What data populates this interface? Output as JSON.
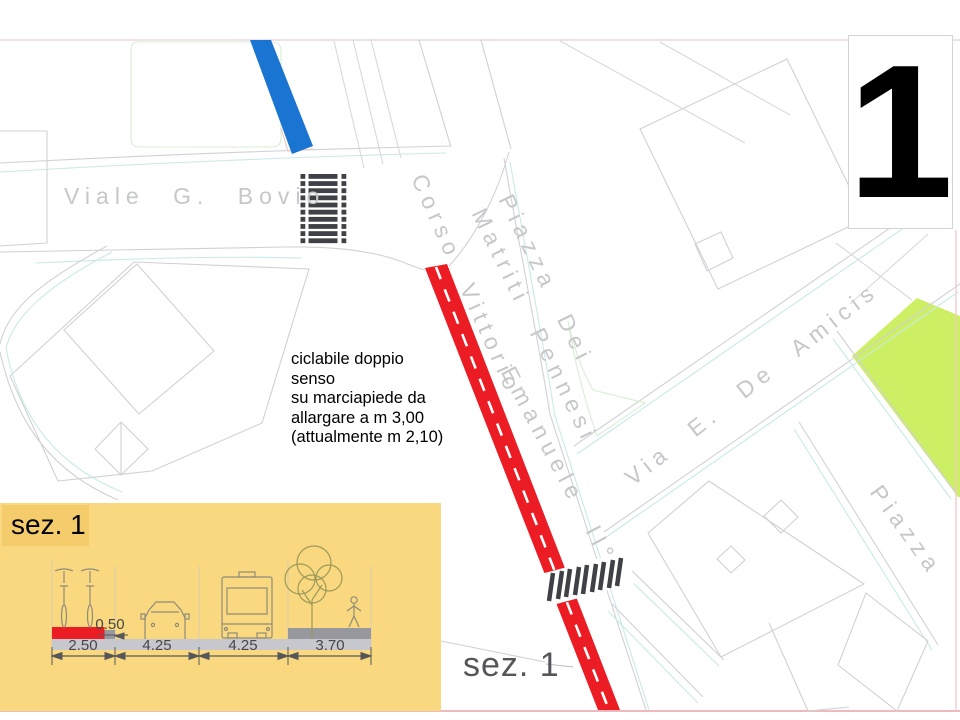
{
  "sheet": {
    "number": "1"
  },
  "map": {
    "streets": {
      "viale_bovio": "Viale G. Bovio",
      "corso_vittorio": "Corso Vittorio",
      "emanuele_ii": "Emanuele II°",
      "piazza_dei": "Piazza Dei",
      "matriti_pennesi": "Matriti Pennesi",
      "via_de_amicis": "Via E. De Amicis",
      "piazza": "Piazza"
    },
    "annotation": "ciclabile doppio senso\nsu marciapiede da\nallargare a m 3,00\n(attualmente m 2,10)",
    "section_callout": "sez. 1",
    "legend_colors": {
      "cycle_path": "#EC1C24",
      "blue_path": "#1A75D2",
      "green_area": "#CDEF63"
    }
  },
  "cross_section": {
    "title": "sez. 1",
    "panel_color": "#FAD87F",
    "dimensions": [
      "2.50",
      "4.25",
      "4.25",
      "3.70"
    ],
    "offset": "0.50"
  }
}
